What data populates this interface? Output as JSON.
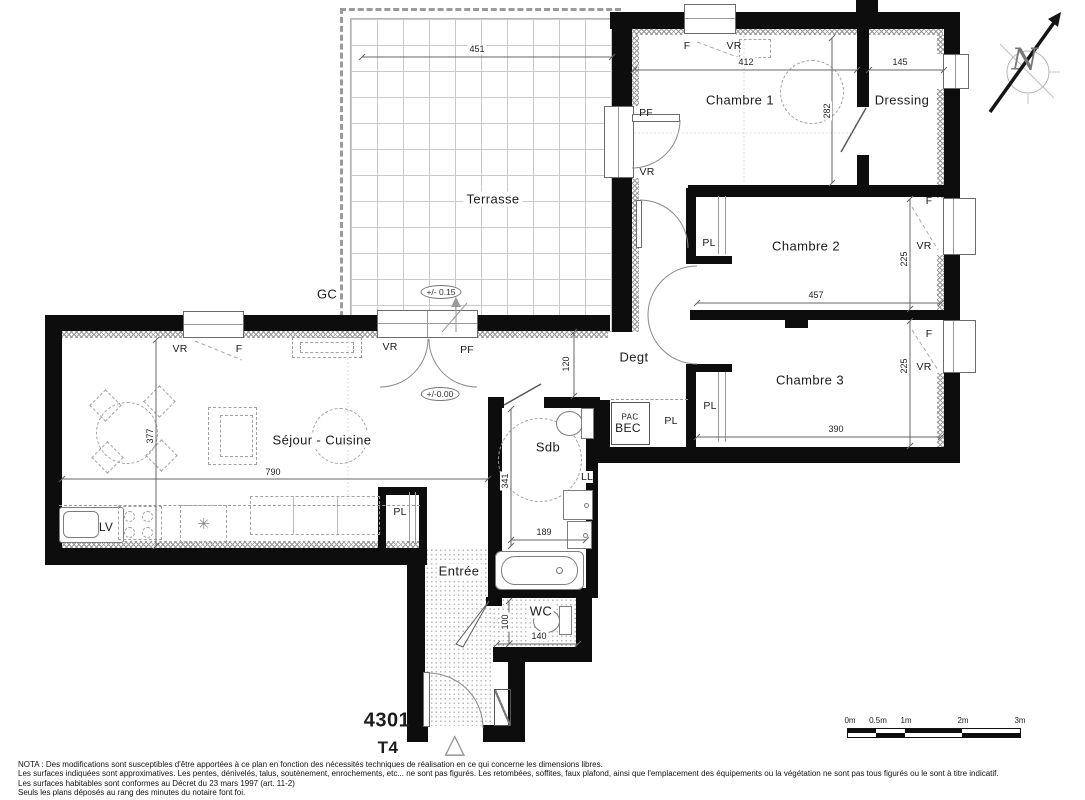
{
  "rooms": {
    "terrasse": "Terrasse",
    "chambre1": "Chambre 1",
    "dressing": "Dressing",
    "chambre2": "Chambre 2",
    "chambre3": "Chambre 3",
    "degt": "Degt",
    "sejour": "Séjour - Cuisine",
    "sdb": "Sdb",
    "entree": "Entrée",
    "wc": "WC"
  },
  "openings": {
    "f": "F",
    "vr": "VR",
    "pf": "PF"
  },
  "fixtures": {
    "pl": "PL",
    "gc": "GC",
    "pac": "PAC",
    "bec": "BEC",
    "ll": "LL",
    "lv": "LV",
    "fridge": "✳",
    "triangle": "△"
  },
  "dimensions": {
    "terrace_w": "451",
    "ch1_w": "412",
    "dressing_w": "145",
    "ch1_h": "282",
    "ch2_w": "457",
    "ch2_h": "225",
    "ch3_w": "390",
    "ch3_h": "225",
    "sejour_h": "377",
    "sejour_w": "790",
    "degt_h": "120",
    "sdb_h": "341",
    "sdb_w": "189",
    "wc_h": "100",
    "wc_w": "140"
  },
  "levels": {
    "terrace": "+/- 0.15",
    "floor": "+/-0.00"
  },
  "plan": {
    "number": "4301",
    "type": "T4"
  },
  "compass": {
    "north": "N"
  },
  "scalebar": {
    "labels": [
      "0m",
      "0.5m",
      "1m",
      "2m",
      "3m"
    ]
  },
  "nota": {
    "line1": "NOTA : Des modifications sont susceptibles d'être apportées à ce plan en fonction des nécessités techniques de réalisation en ce qui concerne les dimensions libres.",
    "line2": "Les surfaces indiquées sont approximatives. Les pentes, dénivelés, talus, soutènement, enrochements, etc... ne sont pas figurés. Les retombées, soffites, faux plafond, ainsi que l'emplacement des équipements ou la végétation ne sont pas tous figurés ou le sont à titre indicatif.",
    "line3": "Les surfaces habitables sont conformes au Décret du 23 mars 1997 (art. 11-2)",
    "line4": "Seuls les plans déposés au rang des minutes du notaire font foi."
  }
}
